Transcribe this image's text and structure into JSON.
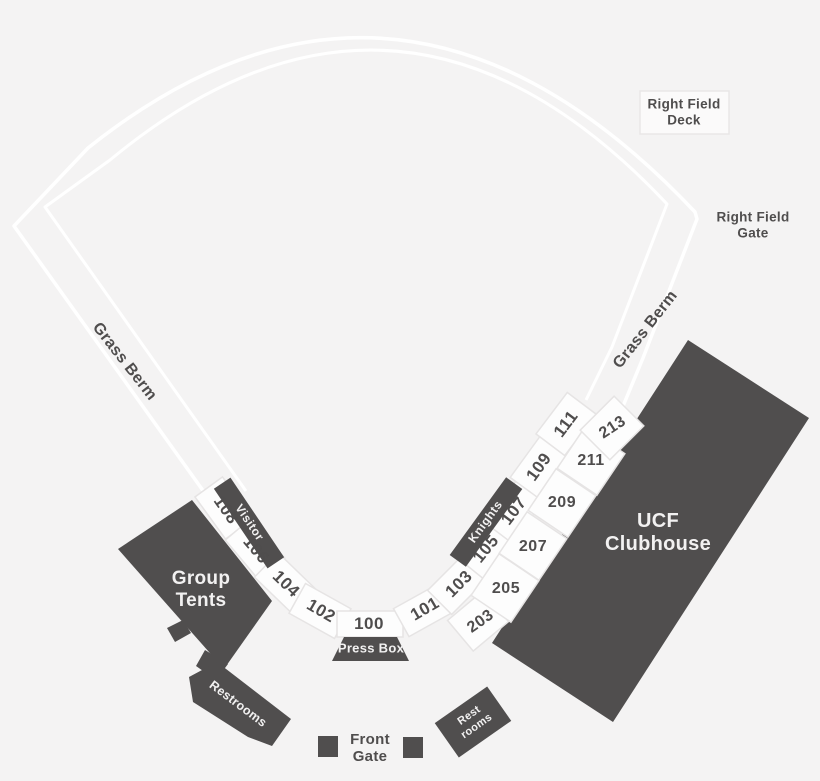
{
  "colors": {
    "background": "#f4f3f3",
    "structure_dark": "#504e4e",
    "section_fill": "#fdfdfd",
    "section_border": "#e6e4e4",
    "field_line": "#ffffff",
    "label_text": "#4f4d4d",
    "label_text_on_dark": "#f2f1f1"
  },
  "areas": {
    "right_field_deck": "Right Field Deck",
    "right_field_gate": "Right Field Gate",
    "grass_berm_left": "Grass Berm",
    "grass_berm_right": "Grass Berm",
    "group_tents": "Group Tents",
    "ucf_clubhouse": "UCF Clubhouse",
    "press_box": "Press Box",
    "restrooms_left": "Restrooms",
    "restrooms_right": "Rest rooms",
    "front_gate": "Front Gate",
    "visitor_dugout": "Visitor",
    "knights_dugout": "Knights"
  },
  "sections": {
    "lower": {
      "s100": "100",
      "s101": "101",
      "s102": "102",
      "s103": "103",
      "s104": "104",
      "s105": "105",
      "s106": "106",
      "s107": "107",
      "s108": "108",
      "s109": "109",
      "s111": "111"
    },
    "upper": {
      "s203": "203",
      "s205": "205",
      "s207": "207",
      "s209": "209",
      "s211": "211",
      "s213": "213"
    }
  }
}
